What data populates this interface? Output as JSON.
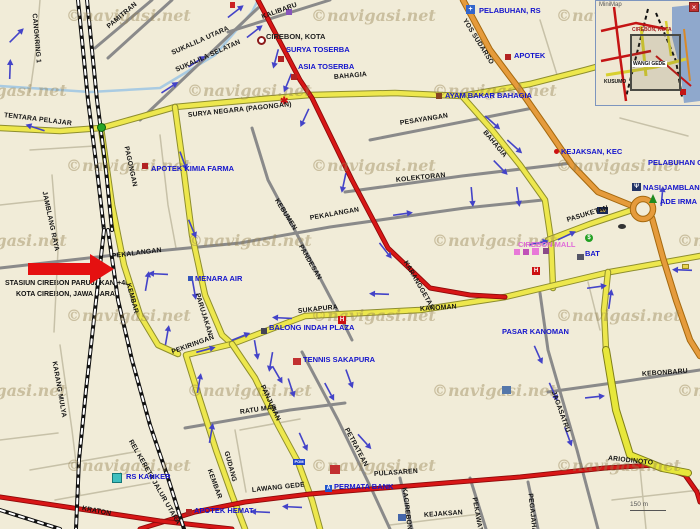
{
  "map": {
    "watermark": {
      "prefix": "©",
      "text": "navigasi.net"
    },
    "annotation": {
      "line1": "STASIUN CIREBON PARUJAKAN(+4M",
      "line2": "KOTA CIREBON, JAWA BARAT"
    },
    "scale": {
      "label": "150 m"
    },
    "minimap": {
      "title": "MiniMap",
      "close_label": "×",
      "labels": [
        {
          "t": "CIREBON, KOTA",
          "x": 36,
          "y": 26,
          "c": "#A02020",
          "bg": ""
        },
        {
          "t": "WANGI GEDE",
          "x": 36,
          "y": 60,
          "c": "#111111",
          "bg": "#ffffff"
        },
        {
          "t": "KUSUMO",
          "x": 8,
          "y": 78,
          "c": "#111111",
          "bg": ""
        }
      ]
    },
    "colors": {
      "background": "#F1ECD8",
      "road_red": "#D81616",
      "road_orange": "#E59B3C",
      "road_yellow": "#EDE74D",
      "road_bright": "#E7E73A",
      "road_gray": "#8A8A8A",
      "arrow_blue": "#4343C8",
      "poi_blue": "#1414CC",
      "mall_pink": "#E06CD8",
      "annotation_red": "#E51010",
      "sea_blue": "#8FA8CC"
    },
    "road_labels": [
      {
        "t": "PAMITRAN",
        "x": 108,
        "y": 24,
        "r": -40
      },
      {
        "t": "SUKALILA UTARA",
        "x": 172,
        "y": 50,
        "r": -24
      },
      {
        "t": "SUKALILA SELATAN",
        "x": 176,
        "y": 67,
        "r": -24
      },
      {
        "t": "KALIBARU",
        "x": 262,
        "y": 14,
        "r": -20
      },
      {
        "t": "CANGKRING 1",
        "x": 34,
        "y": 10,
        "r": 85
      },
      {
        "t": "TENTARA PELAJAR",
        "x": 4,
        "y": 112,
        "r": 7
      },
      {
        "t": "SURYA NEGARA (PAGONGAN)",
        "x": 188,
        "y": 112,
        "r": -6
      },
      {
        "t": "PAGONGAN",
        "x": 126,
        "y": 143,
        "r": 78
      },
      {
        "t": "BAHAGIA",
        "x": 334,
        "y": 74,
        "r": -5
      },
      {
        "t": "BAHAGIA",
        "x": 484,
        "y": 128,
        "r": 50
      },
      {
        "t": "PESAYANGAN",
        "x": 400,
        "y": 120,
        "r": -9
      },
      {
        "t": "KOLEKTORAN",
        "x": 396,
        "y": 177,
        "r": -6
      },
      {
        "t": "PEKALANGAN",
        "x": 310,
        "y": 215,
        "r": -10
      },
      {
        "t": "PEKALANGAN",
        "x": 112,
        "y": 253,
        "r": -7
      },
      {
        "t": "KEBUMEN",
        "x": 276,
        "y": 196,
        "r": 58
      },
      {
        "t": "PANDESAN",
        "x": 300,
        "y": 242,
        "r": 60
      },
      {
        "t": "KARANGGETAS",
        "x": 405,
        "y": 258,
        "r": 60
      },
      {
        "t": "PASUKETAN",
        "x": 567,
        "y": 217,
        "r": -17
      },
      {
        "t": "KANOMAN",
        "x": 420,
        "y": 306,
        "r": -4
      },
      {
        "t": "SUKAPURA",
        "x": 298,
        "y": 308,
        "r": -6
      },
      {
        "t": "PARUJAKAN",
        "x": 197,
        "y": 290,
        "r": 73
      },
      {
        "t": "KEMBAR",
        "x": 128,
        "y": 280,
        "r": 75
      },
      {
        "t": "KEMBAR",
        "x": 209,
        "y": 466,
        "r": 70
      },
      {
        "t": "GUDANG",
        "x": 226,
        "y": 448,
        "r": 75
      },
      {
        "t": "PEKIRINGAN",
        "x": 172,
        "y": 349,
        "r": -20
      },
      {
        "t": "PANJUNAN",
        "x": 262,
        "y": 382,
        "r": 65
      },
      {
        "t": "RATU MAS",
        "x": 240,
        "y": 409,
        "r": -8
      },
      {
        "t": "PETRATEAN",
        "x": 346,
        "y": 425,
        "r": 62
      },
      {
        "t": "LAWANG GEDE",
        "x": 252,
        "y": 487,
        "r": -6
      },
      {
        "t": "PULASAREN",
        "x": 374,
        "y": 471,
        "r": -4
      },
      {
        "t": "ARIODINOTO",
        "x": 608,
        "y": 455,
        "r": 6
      },
      {
        "t": "KEBONBARU",
        "x": 642,
        "y": 371,
        "r": -4
      },
      {
        "t": "JAGASATRU",
        "x": 553,
        "y": 388,
        "r": 70
      },
      {
        "t": "KACIREBONAN",
        "x": 404,
        "y": 484,
        "r": 83
      },
      {
        "t": "PEKAWATAN",
        "x": 474,
        "y": 494,
        "r": 80
      },
      {
        "t": "PEGAJAHAN",
        "x": 530,
        "y": 490,
        "r": 84
      },
      {
        "t": "KEJAKSAN",
        "x": 424,
        "y": 512,
        "r": -4
      },
      {
        "t": "KRATON",
        "x": 82,
        "y": 505,
        "r": 11
      },
      {
        "t": "KARANG MULYA",
        "x": 54,
        "y": 358,
        "r": 80
      },
      {
        "t": "JAMBLANG RAYA",
        "x": 44,
        "y": 188,
        "r": 78
      },
      {
        "t": "REL KERETA JALUR UTARA",
        "x": 130,
        "y": 437,
        "r": 60
      },
      {
        "t": "YOS SUDARSO",
        "x": 464,
        "y": 16,
        "r": 58
      }
    ],
    "poi_labels": [
      {
        "t": "PELABUHAN, RS",
        "x": 479,
        "y": 6
      },
      {
        "t": "APOTEK",
        "x": 514,
        "y": 51
      },
      {
        "t": "AYAM BAKAR BAHAGIA",
        "x": 445,
        "y": 91
      },
      {
        "t": "KEJAKSAN, KEC",
        "x": 561,
        "y": 147
      },
      {
        "t": "PELABUHAN CIREBON",
        "x": 648,
        "y": 158
      },
      {
        "t": "NASI JAMBLANG",
        "x": 643,
        "y": 183
      },
      {
        "t": "ADE IRMA",
        "x": 660,
        "y": 197
      },
      {
        "t": "APOTEK KIMIA FARMA",
        "x": 151,
        "y": 164
      },
      {
        "t": "SURYA TOSERBA",
        "x": 286,
        "y": 45
      },
      {
        "t": "ASIA TOSERBA",
        "x": 298,
        "y": 62
      },
      {
        "t": "CIREBON, KOTA",
        "x": 266,
        "y": 32,
        "c": "#222222"
      },
      {
        "t": "MENARA AIR",
        "x": 195,
        "y": 274
      },
      {
        "t": "BALONG INDAH PLAZA",
        "x": 269,
        "y": 323
      },
      {
        "t": "PASAR KANOMAN",
        "x": 502,
        "y": 327
      },
      {
        "t": "CIREBON MALL",
        "x": 518,
        "y": 240,
        "c": "#E06CD8"
      },
      {
        "t": "BAT",
        "x": 585,
        "y": 249
      },
      {
        "t": "TENNIS SAKAPURA",
        "x": 303,
        "y": 355
      },
      {
        "t": "RS KANKER",
        "x": 126,
        "y": 472
      },
      {
        "t": "PERMATA BANK",
        "x": 334,
        "y": 482
      },
      {
        "t": "APOTEK HEMAT",
        "x": 194,
        "y": 506
      }
    ],
    "icons": [
      {
        "n": "station-marker-icon",
        "x": 257,
        "y": 36,
        "w": 9,
        "h": 9,
        "ring": "#8B1A1A"
      },
      {
        "n": "roundabout-dot-icon",
        "x": 97,
        "y": 123,
        "w": 9,
        "h": 9,
        "bg": "#28A428",
        "bd": "#0B5E0B",
        "round": 1
      },
      {
        "n": "store-icon",
        "x": 278,
        "y": 56,
        "w": 6,
        "h": 6,
        "bg": "#B22222"
      },
      {
        "n": "store-icon",
        "x": 291,
        "y": 74,
        "w": 6,
        "h": 6,
        "bg": "#B22222"
      },
      {
        "n": "pharmacy-icon",
        "x": 142,
        "y": 163,
        "w": 6,
        "h": 6,
        "bg": "#B22222"
      },
      {
        "n": "hospital-icon",
        "x": 466,
        "y": 5,
        "w": 9,
        "h": 9,
        "bg": "#3366CC",
        "fg": "#ffffff",
        "g": "+",
        "fs": 7
      },
      {
        "n": "pharmacy-icon",
        "x": 505,
        "y": 54,
        "w": 6,
        "h": 6,
        "bg": "#B22222"
      },
      {
        "n": "restaurant-icon",
        "x": 436,
        "y": 93,
        "w": 6,
        "h": 6,
        "bg": "#884422"
      },
      {
        "n": "district-dot-icon",
        "x": 554,
        "y": 149,
        "w": 5,
        "h": 5,
        "bg": "#CC1111",
        "round": 1
      },
      {
        "n": "mall-icon",
        "x": 514,
        "y": 249,
        "w": 6,
        "h": 6,
        "bg": "#E878D8"
      },
      {
        "n": "mall-icon",
        "x": 523,
        "y": 249,
        "w": 6,
        "h": 6,
        "bg": "#C050B8"
      },
      {
        "n": "mall-icon",
        "x": 532,
        "y": 248,
        "w": 7,
        "h": 7,
        "bg": "#E878D8"
      },
      {
        "n": "mall-icon",
        "x": 543,
        "y": 248,
        "w": 6,
        "h": 6,
        "bg": "#8A4A88"
      },
      {
        "n": "hotel-icon",
        "x": 338,
        "y": 316,
        "w": 8,
        "h": 8,
        "bg": "#CC1111",
        "fg": "#ffffff",
        "g": "H",
        "fs": 6
      },
      {
        "n": "hotel-icon",
        "x": 532,
        "y": 267,
        "w": 8,
        "h": 8,
        "bg": "#CC1111",
        "fg": "#ffffff",
        "g": "H",
        "fs": 6
      },
      {
        "n": "factory-icon",
        "x": 577,
        "y": 254,
        "w": 7,
        "h": 6,
        "bg": "#555566"
      },
      {
        "n": "water-tower-icon",
        "x": 188,
        "y": 276,
        "w": 5,
        "h": 5,
        "bg": "#3355BB"
      },
      {
        "n": "plaza-icon",
        "x": 261,
        "y": 328,
        "w": 6,
        "h": 6,
        "bg": "#444455"
      },
      {
        "n": "hospital-icon",
        "x": 112,
        "y": 473,
        "w": 10,
        "h": 10,
        "bg": "#3FBFBF",
        "bd": "#157878"
      },
      {
        "n": "fuel-icon",
        "x": 293,
        "y": 459,
        "w": 12,
        "h": 6,
        "bg": "#2244CC",
        "fg": "#ffffff",
        "g": "POM",
        "fs": 4
      },
      {
        "n": "restaurant-icon",
        "x": 632,
        "y": 183,
        "w": 9,
        "h": 8,
        "bg": "#223366",
        "fg": "#ffffff",
        "g": "Ψ",
        "fs": 6
      },
      {
        "n": "tree-icon",
        "x": 649,
        "y": 194,
        "kind": "tree"
      },
      {
        "n": "money-changer-icon",
        "x": 585,
        "y": 234,
        "w": 8,
        "h": 8,
        "bg": "#22A022",
        "fg": "#ffffff",
        "g": "$",
        "fs": 6,
        "round": 1
      },
      {
        "n": "aw-restaurant-icon",
        "x": 597,
        "y": 207,
        "w": 11,
        "h": 7,
        "bg": "#1A2A55",
        "fg": "#F0C040",
        "g": "AW",
        "fs": 4
      },
      {
        "n": "bank-building-icon",
        "x": 502,
        "y": 386,
        "w": 9,
        "h": 8,
        "bg": "#5577AA"
      },
      {
        "n": "market-building-icon",
        "x": 330,
        "y": 465,
        "w": 10,
        "h": 9,
        "bg": "#C23030"
      },
      {
        "n": "building-icon",
        "x": 398,
        "y": 514,
        "w": 8,
        "h": 7,
        "bg": "#4466AA"
      },
      {
        "n": "building-icon",
        "x": 286,
        "y": 9,
        "w": 6,
        "h": 6,
        "bg": "#8855BB"
      },
      {
        "n": "poi-icon",
        "x": 230,
        "y": 2,
        "w": 5,
        "h": 6,
        "bg": "#CC2222"
      },
      {
        "n": "poi-dot-icon",
        "x": 618,
        "y": 224,
        "w": 8,
        "h": 5,
        "bg": "#333333",
        "round": 1
      },
      {
        "n": "kiosk-icon",
        "x": 682,
        "y": 264,
        "w": 7,
        "h": 5,
        "bg": "#E8D44D",
        "bd": "#998822"
      },
      {
        "n": "bank-icon",
        "x": 325,
        "y": 485,
        "w": 7,
        "h": 7,
        "bg": "#2255CC",
        "fg": "#ffffff",
        "g": "A",
        "fs": 5
      },
      {
        "n": "clinic-icon",
        "x": 280,
        "y": 97,
        "kind": "glyph",
        "fg": "#CC1111",
        "g": "✱",
        "fs": 10
      },
      {
        "n": "pharmacy-icon",
        "x": 186,
        "y": 509,
        "w": 6,
        "h": 6,
        "bg": "#B22222"
      },
      {
        "n": "tennis-icon",
        "x": 293,
        "y": 358,
        "w": 8,
        "h": 7,
        "bg": "#C23030"
      }
    ],
    "arrows": [
      {
        "x": 235,
        "y": 12,
        "a": -38
      },
      {
        "x": 254,
        "y": 32,
        "a": -38
      },
      {
        "x": 196,
        "y": 62,
        "a": -33
      },
      {
        "x": 169,
        "y": 88,
        "a": -33
      },
      {
        "x": 10,
        "y": 70,
        "a": -88
      },
      {
        "x": 16,
        "y": 36,
        "a": -45
      },
      {
        "x": 36,
        "y": 128,
        "a": -162
      },
      {
        "x": 276,
        "y": 58,
        "a": 105
      },
      {
        "x": 288,
        "y": 82,
        "a": 112
      },
      {
        "x": 305,
        "y": 117,
        "a": 115
      },
      {
        "x": 344,
        "y": 182,
        "a": 102
      },
      {
        "x": 385,
        "y": 250,
        "a": 52
      },
      {
        "x": 492,
        "y": 122,
        "a": 42
      },
      {
        "x": 514,
        "y": 146,
        "a": 42
      },
      {
        "x": 500,
        "y": 167,
        "a": 46
      },
      {
        "x": 380,
        "y": 294,
        "a": 182
      },
      {
        "x": 683,
        "y": 270,
        "a": 182
      },
      {
        "x": 402,
        "y": 214,
        "a": -8
      },
      {
        "x": 566,
        "y": 236,
        "a": -25
      },
      {
        "x": 538,
        "y": 243,
        "a": -12
      },
      {
        "x": 596,
        "y": 287,
        "a": -8
      },
      {
        "x": 518,
        "y": 196,
        "a": 82
      },
      {
        "x": 662,
        "y": 197,
        "a": -85
      },
      {
        "x": 147,
        "y": 282,
        "a": -80
      },
      {
        "x": 167,
        "y": 336,
        "a": -80
      },
      {
        "x": 199,
        "y": 384,
        "a": -80
      },
      {
        "x": 211,
        "y": 434,
        "a": -80
      },
      {
        "x": 159,
        "y": 274,
        "a": 183
      },
      {
        "x": 194,
        "y": 289,
        "a": 80
      },
      {
        "x": 205,
        "y": 350,
        "a": -15
      },
      {
        "x": 240,
        "y": 337,
        "a": -22
      },
      {
        "x": 256,
        "y": 349,
        "a": 80
      },
      {
        "x": 271,
        "y": 361,
        "a": 100
      },
      {
        "x": 283,
        "y": 318,
        "a": 183
      },
      {
        "x": 277,
        "y": 374,
        "a": 60
      },
      {
        "x": 291,
        "y": 387,
        "a": 72
      },
      {
        "x": 303,
        "y": 441,
        "a": 66
      },
      {
        "x": 329,
        "y": 391,
        "a": 62
      },
      {
        "x": 349,
        "y": 378,
        "a": 70
      },
      {
        "x": 364,
        "y": 441,
        "a": 48
      },
      {
        "x": 293,
        "y": 507,
        "a": 183
      },
      {
        "x": 261,
        "y": 512,
        "a": 183
      },
      {
        "x": 594,
        "y": 397,
        "a": -6
      },
      {
        "x": 538,
        "y": 354,
        "a": 66
      },
      {
        "x": 553,
        "y": 391,
        "a": 66
      },
      {
        "x": 568,
        "y": 436,
        "a": 70
      },
      {
        "x": 472,
        "y": 196,
        "a": 85
      },
      {
        "x": 183,
        "y": 160,
        "a": 70
      },
      {
        "x": 192,
        "y": 228,
        "a": 68
      },
      {
        "x": 610,
        "y": 300,
        "a": -82
      }
    ]
  }
}
